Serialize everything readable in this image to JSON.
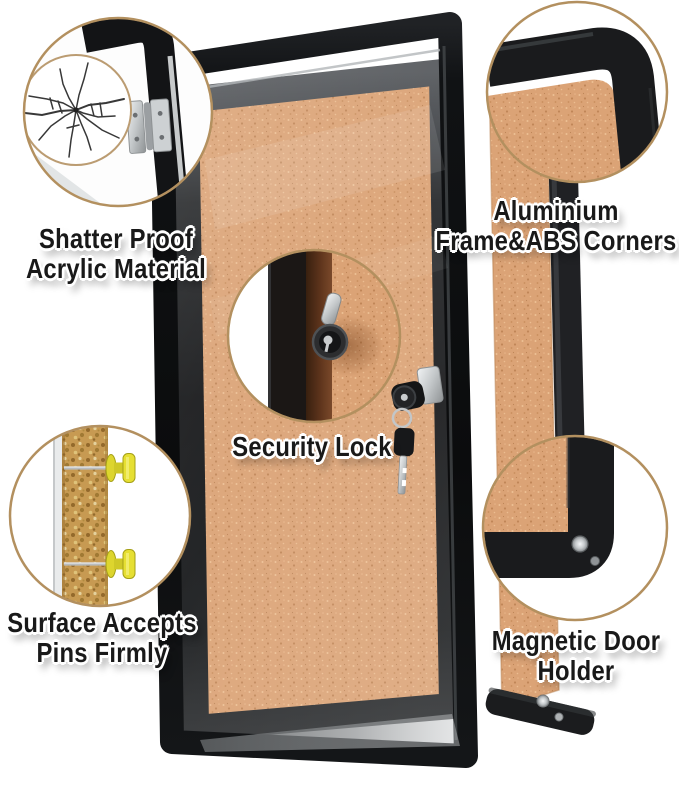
{
  "image": {
    "type": "product feature infographic",
    "subject": "Enclosed cork bulletin board with lockable acrylic door",
    "background": "#ffffff"
  },
  "palette": {
    "cork": "#d9a176",
    "frame_black": "#1b1c1e",
    "callout_ring": "#b3905f",
    "pin_yellow": "#e6df33",
    "metal_silver": "#cfd2d4",
    "label_text": "#191919",
    "label_halo": "#ffffff"
  },
  "callouts": {
    "shatter_proof": {
      "line1": "Shatter Proof",
      "line2": "Acrylic Material"
    },
    "aluminium_frame": {
      "line1": "Aluminium",
      "line2": "Frame&ABS Corners"
    },
    "security_lock": {
      "line1": "Security Lock"
    },
    "surface_pins": {
      "line1": "Surface Accepts",
      "line2": "Pins Firmly"
    },
    "magnetic_holder": {
      "line1": "Magnetic Door",
      "line2": "Holder"
    }
  }
}
